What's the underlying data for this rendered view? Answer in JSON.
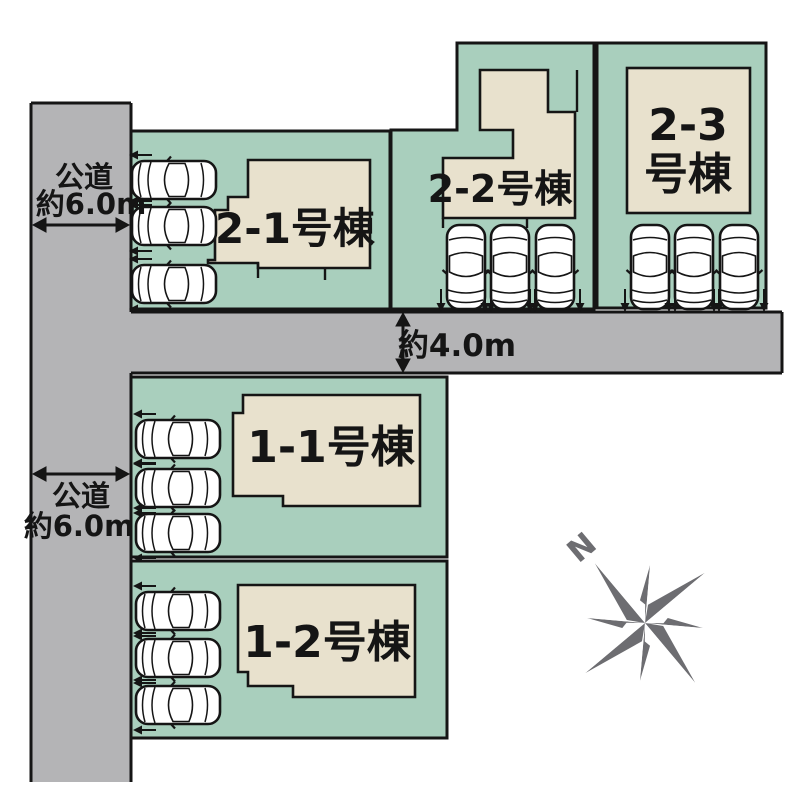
{
  "site_plan": {
    "roads": {
      "west_road_upper": {
        "name_label": "公道",
        "width_label": "約6.0m"
      },
      "west_road_lower": {
        "name_label": "公道",
        "width_label": "約6.0m"
      },
      "middle_road": {
        "width_label": "約4.0m"
      }
    },
    "parcels": [
      {
        "id": "2-1",
        "building_label": "2-1号棟",
        "car_count": 3
      },
      {
        "id": "2-2",
        "building_label": "2-2号棟",
        "car_count": 3
      },
      {
        "id": "2-3",
        "building_label_line1": "2-3",
        "building_label_line2": "号棟",
        "car_count": 3
      },
      {
        "id": "1-1",
        "building_label": "1-1号棟",
        "car_count": 3
      },
      {
        "id": "1-2",
        "building_label": "1-2号棟",
        "car_count": 3
      }
    ],
    "compass": {
      "north_label": "N"
    },
    "colors": {
      "parcel_green": "#a9cfbd",
      "building_beige": "#e8e1cd",
      "road_gray": "#b4b4b6",
      "outline_black": "#151515",
      "compass_gray": "#6d6d71"
    }
  }
}
